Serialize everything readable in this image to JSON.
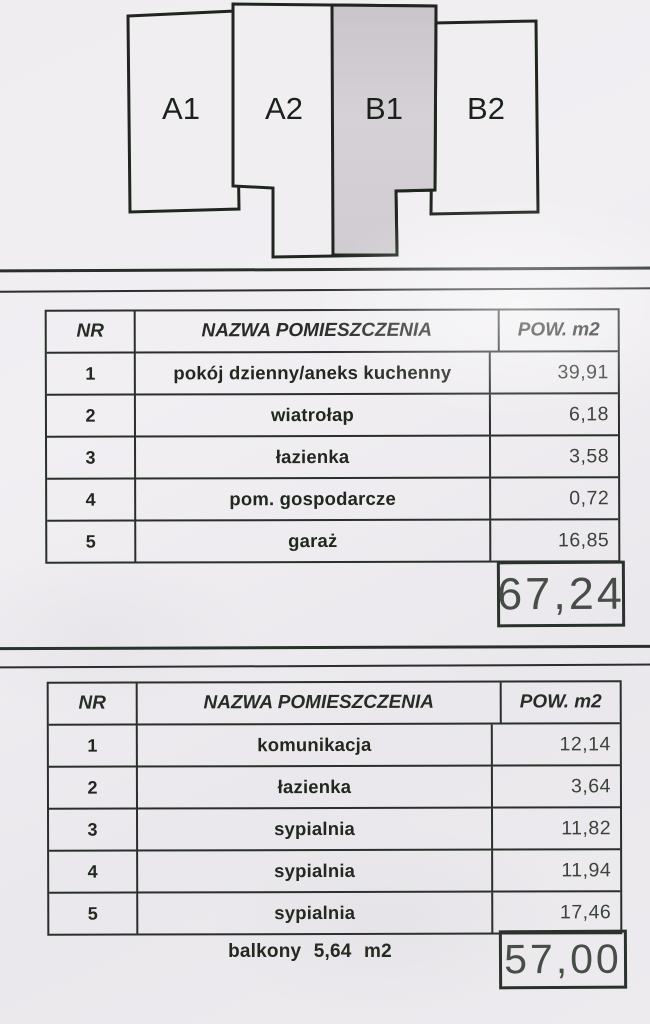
{
  "diagram": {
    "units": [
      {
        "label": "A1"
      },
      {
        "label": "A2"
      },
      {
        "label": "B1"
      },
      {
        "label": "B2"
      }
    ],
    "highlighted_unit": "B1",
    "highlight_color": "#d2ced3",
    "outline_color": "#20261f"
  },
  "tables": [
    {
      "headers": {
        "nr": "NR",
        "name": "NAZWA POMIESZCZENIA",
        "area": "POW. m2"
      },
      "rows": [
        {
          "nr": "1",
          "name": "pokój dzienny/aneks kuchenny",
          "area": "39,91"
        },
        {
          "nr": "2",
          "name": "wiatrołap",
          "area": "6,18"
        },
        {
          "nr": "3",
          "name": "łazienka",
          "area": "3,58"
        },
        {
          "nr": "4",
          "name": "pom. gospodarcze",
          "area": "0,72"
        },
        {
          "nr": "5",
          "name": "garaż",
          "area": "16,85"
        }
      ],
      "total": "67,24"
    },
    {
      "headers": {
        "nr": "NR",
        "name": "NAZWA POMIESZCZENIA",
        "area": "POW. m2"
      },
      "rows": [
        {
          "nr": "1",
          "name": "komunikacja",
          "area": "12,14"
        },
        {
          "nr": "2",
          "name": "łazienka",
          "area": "3,64"
        },
        {
          "nr": "3",
          "name": "sypialnia",
          "area": "11,82"
        },
        {
          "nr": "4",
          "name": "sypialnia",
          "area": "11,94"
        },
        {
          "nr": "5",
          "name": "sypialnia",
          "area": "17,46"
        }
      ],
      "note": "balkony 5,64 m2",
      "total": "57,00"
    }
  ]
}
